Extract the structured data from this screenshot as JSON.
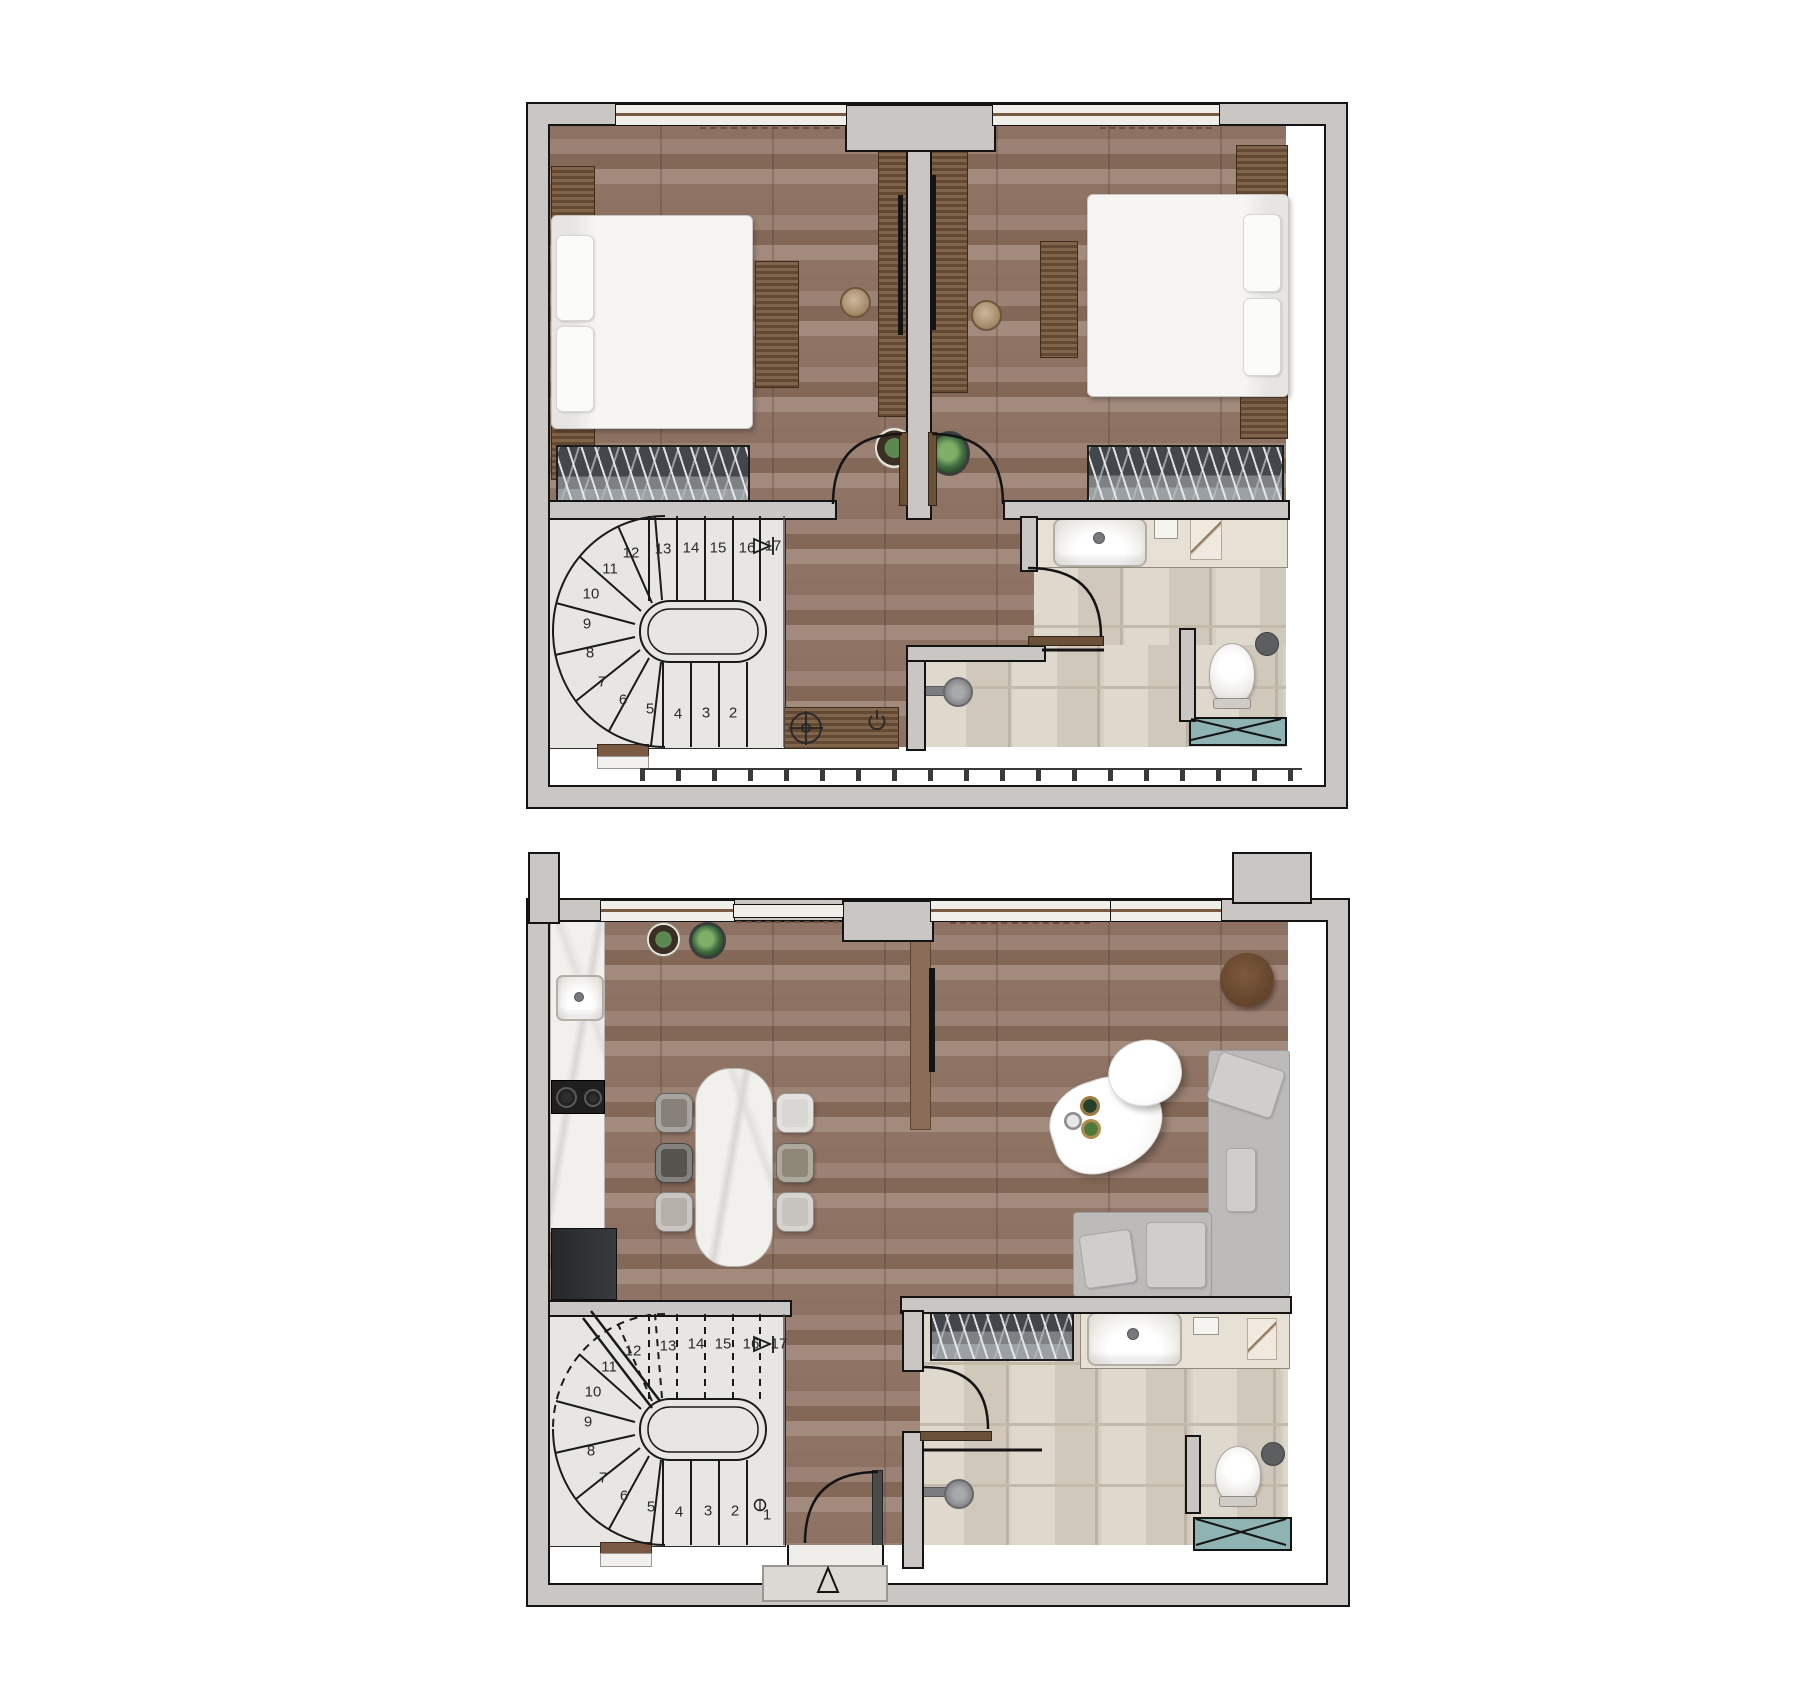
{
  "document": {
    "type": "two-storey apartment floor plan",
    "text_visible": "stair step numbers only"
  },
  "colors": {
    "wood_floor": "#94796a",
    "tile_floor": "#d8d0c2",
    "wall_fill": "#c9c6c3",
    "wall_line": "#141414",
    "stair_floor": "#e8e6e2",
    "teal_fixture": "#8fb2b3",
    "wood_furniture": "#6f5138",
    "brown_partition": "#8a6d58",
    "sofa_gray": "#bcbbba",
    "marble": "#f2f0ec"
  },
  "upper_plan": {
    "stairs": {
      "steps": [
        {
          "n": "2",
          "x": 733,
          "y": 713
        },
        {
          "n": "3",
          "x": 706,
          "y": 713
        },
        {
          "n": "4",
          "x": 678,
          "y": 714
        },
        {
          "n": "5",
          "x": 650,
          "y": 709
        },
        {
          "n": "6",
          "x": 623,
          "y": 700
        },
        {
          "n": "7",
          "x": 602,
          "y": 682
        },
        {
          "n": "8",
          "x": 590,
          "y": 653
        },
        {
          "n": "9",
          "x": 587,
          "y": 624
        },
        {
          "n": "10",
          "x": 591,
          "y": 594
        },
        {
          "n": "11",
          "x": 610,
          "y": 569
        },
        {
          "n": "12",
          "x": 631,
          "y": 553
        },
        {
          "n": "13",
          "x": 663,
          "y": 549
        },
        {
          "n": "14",
          "x": 691,
          "y": 548
        },
        {
          "n": "15",
          "x": 718,
          "y": 548
        },
        {
          "n": "16",
          "x": 747,
          "y": 548
        },
        {
          "n": "17",
          "x": 773,
          "y": 546
        }
      ]
    }
  },
  "ground_plan": {
    "stairs": {
      "steps": [
        {
          "n": "1",
          "x": 767,
          "y": 1515
        },
        {
          "n": "2",
          "x": 735,
          "y": 1511
        },
        {
          "n": "3",
          "x": 708,
          "y": 1511
        },
        {
          "n": "4",
          "x": 679,
          "y": 1512
        },
        {
          "n": "5",
          "x": 651,
          "y": 1507
        },
        {
          "n": "6",
          "x": 624,
          "y": 1496
        },
        {
          "n": "7",
          "x": 603,
          "y": 1478
        },
        {
          "n": "8",
          "x": 591,
          "y": 1451
        },
        {
          "n": "9",
          "x": 588,
          "y": 1422
        },
        {
          "n": "10",
          "x": 593,
          "y": 1392
        },
        {
          "n": "11",
          "x": 609,
          "y": 1367
        },
        {
          "n": "12",
          "x": 633,
          "y": 1351
        },
        {
          "n": "13",
          "x": 668,
          "y": 1346
        },
        {
          "n": "14",
          "x": 696,
          "y": 1344
        },
        {
          "n": "15",
          "x": 723,
          "y": 1344
        },
        {
          "n": "16",
          "x": 751,
          "y": 1344
        },
        {
          "n": "17",
          "x": 779,
          "y": 1344
        }
      ]
    }
  }
}
